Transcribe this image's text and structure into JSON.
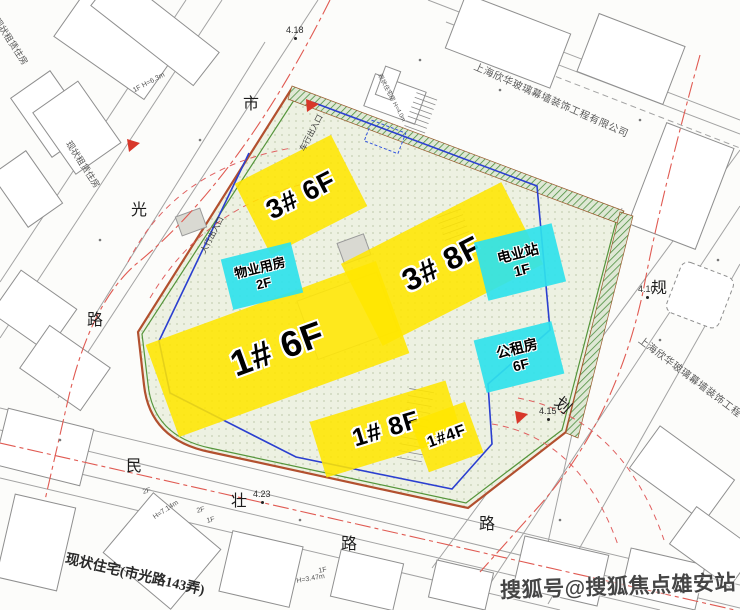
{
  "site": {
    "buildings": [
      {
        "id": "3-6f",
        "label": "3# 6F"
      },
      {
        "id": "3-8f",
        "label": "3# 8F"
      },
      {
        "id": "1-6f",
        "label": "1# 6F"
      },
      {
        "id": "1-8f",
        "label": "1# 8F"
      },
      {
        "id": "1-4f",
        "label": "1#4F"
      }
    ],
    "facilities": [
      {
        "id": "property-room",
        "name": "物业用房",
        "floor": "2F"
      },
      {
        "id": "power-station",
        "name": "电业站",
        "floor": "1F"
      },
      {
        "id": "public-rental",
        "name": "公租房",
        "floor": "6F"
      }
    ]
  },
  "roads": {
    "left": {
      "chars": [
        "市",
        "光",
        "路"
      ]
    },
    "bottom": {
      "chars": [
        "民",
        "壮",
        "路"
      ]
    },
    "right": {
      "chars": [
        "规",
        "划",
        "路"
      ]
    }
  },
  "elevations": [
    {
      "value": "4.18"
    },
    {
      "value": "4.10"
    },
    {
      "value": "4.15"
    },
    {
      "value": "4.23"
    }
  ],
  "entrances": {
    "vehicle": "车行出入口",
    "pedestrian": "人行出入口"
  },
  "neighbors": {
    "company": "上海欣华玻璃幕墙装饰工程有限公司",
    "existing_residence": "现状住宅(市光路143弄)",
    "rental_housing": "现状租赁住房"
  },
  "annotations": {
    "biz": "1F H=6.3m",
    "h714": "H=7.14m",
    "h347": "H=3.47m",
    "f2a": "2F",
    "f2b": "2F",
    "f1a": "1F",
    "f1b": "1F",
    "existing_small": "现状住宅房 H=4.0m"
  },
  "watermark": {
    "text": "搜狐号@搜狐焦点雄安站"
  },
  "colors": {
    "highlight_yellow": "#ffe600",
    "highlight_cyan": "#2fe2ec",
    "site_boundary_red": "#b2502f",
    "site_boundary_green": "#55953b",
    "red_line": "#e05a52",
    "blue_line": "#2b3fd0"
  }
}
